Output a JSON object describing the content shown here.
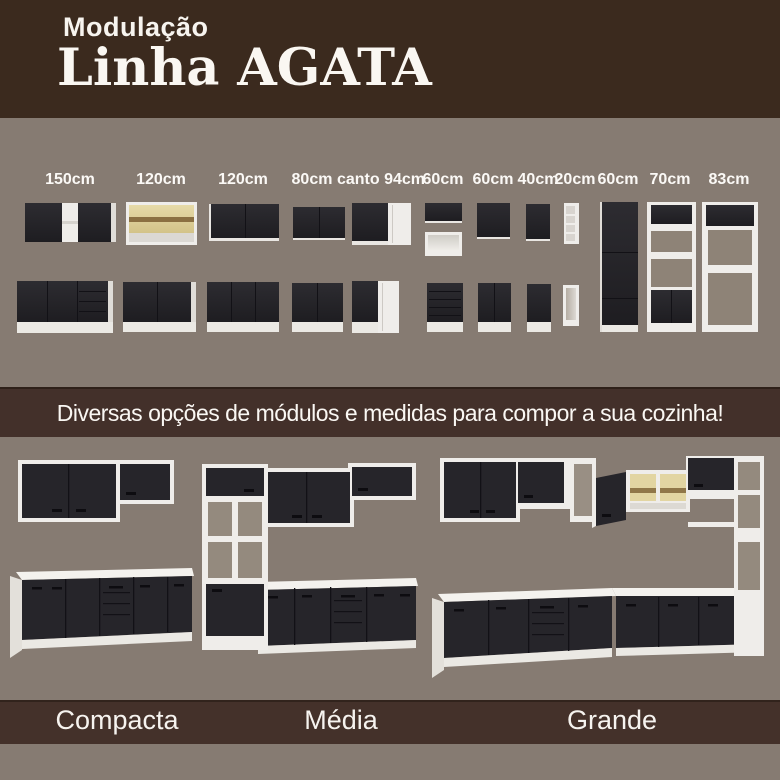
{
  "header": {
    "subtitle": "Modulação",
    "title": "Linha AGATA"
  },
  "modules": {
    "labels": [
      "150cm",
      "120cm",
      "120cm",
      "80cm",
      "canto 94cm",
      "60cm",
      "60cm",
      "40cm",
      "20cm",
      "60cm",
      "70cm",
      "83cm"
    ]
  },
  "banner": {
    "text": "Diversas opções de módulos e medidas para compor a sua cozinha!"
  },
  "kitchens": {
    "labels": [
      "Compacta",
      "Média",
      "Grande"
    ]
  },
  "colors": {
    "header_brown": "#3b2a1e",
    "band_brown": "#43302a",
    "background_taupe": "#867b72",
    "cabinet_black": "#26252a",
    "cabinet_white": "#efedea",
    "glass_amber": "#ddcf96"
  }
}
